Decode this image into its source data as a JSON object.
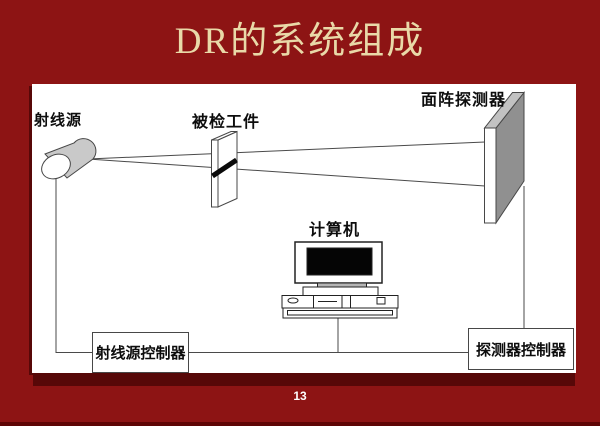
{
  "slide": {
    "title": "DR的系统组成",
    "page_number": "13"
  },
  "diagram": {
    "labels": {
      "ray_source": "射线源",
      "workpiece": "被检工件",
      "detector": "面阵探测器",
      "computer": "计算机",
      "source_controller": "射线源控制器",
      "detector_controller": "探测器控制器"
    }
  },
  "colors": {
    "background": "#8D1414",
    "title_text": "#E9D9A8",
    "panel": "#FFFFFF",
    "panel_shadow": "#570808",
    "diagram_line": "#4A4A4A",
    "detector_side": "#909090",
    "detector_top": "#C2C2C2",
    "source_body": "#C9C9C9",
    "defect_band": "#0A0A0A",
    "screen": "#050505"
  }
}
